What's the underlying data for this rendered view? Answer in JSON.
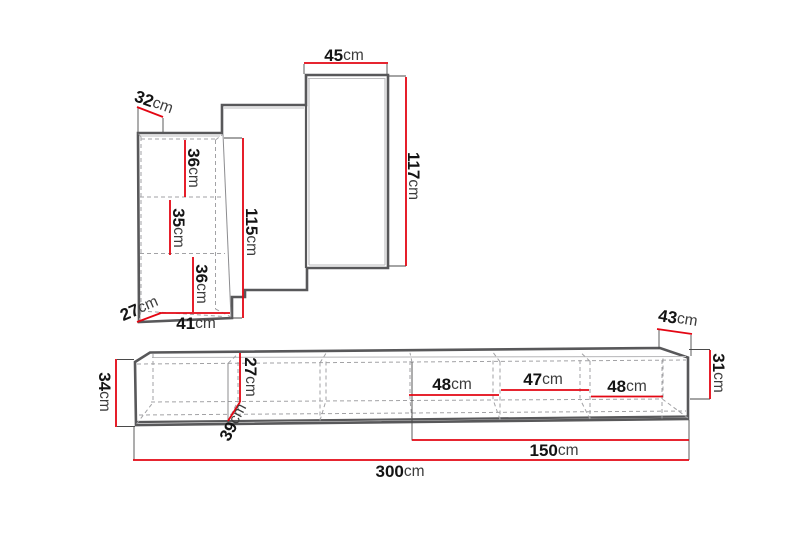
{
  "figure": {
    "type": "furniture-dimension-diagram",
    "background": "#ffffff",
    "colors": {
      "dimension_line": "#e30613",
      "outline": "#58585a",
      "dashed_hidden_edge": "#a2a2a5",
      "label_number": "#141414",
      "label_unit": "#3c3c3c"
    },
    "top_unit": {
      "description": "stepped wall unit elevation",
      "dims": [
        {
          "num": "32",
          "unit": "cm"
        },
        {
          "num": "45",
          "unit": "cm"
        },
        {
          "num": "117",
          "unit": "cm"
        },
        {
          "num": "115",
          "unit": "cm"
        },
        {
          "num": "36",
          "unit": "cm"
        },
        {
          "num": "35",
          "unit": "cm"
        },
        {
          "num": "36",
          "unit": "cm"
        },
        {
          "num": "27",
          "unit": "cm"
        },
        {
          "num": "41",
          "unit": "cm"
        }
      ]
    },
    "bottom_unit": {
      "description": "long low bench elevation",
      "dims": [
        {
          "num": "43",
          "unit": "cm"
        },
        {
          "num": "31",
          "unit": "cm"
        },
        {
          "num": "34",
          "unit": "cm"
        },
        {
          "num": "27",
          "unit": "cm"
        },
        {
          "num": "39",
          "unit": "cm"
        },
        {
          "num": "48",
          "unit": "cm"
        },
        {
          "num": "47",
          "unit": "cm"
        },
        {
          "num": "48",
          "unit": "cm"
        },
        {
          "num": "150",
          "unit": "cm"
        },
        {
          "num": "300",
          "unit": "cm"
        }
      ]
    }
  }
}
